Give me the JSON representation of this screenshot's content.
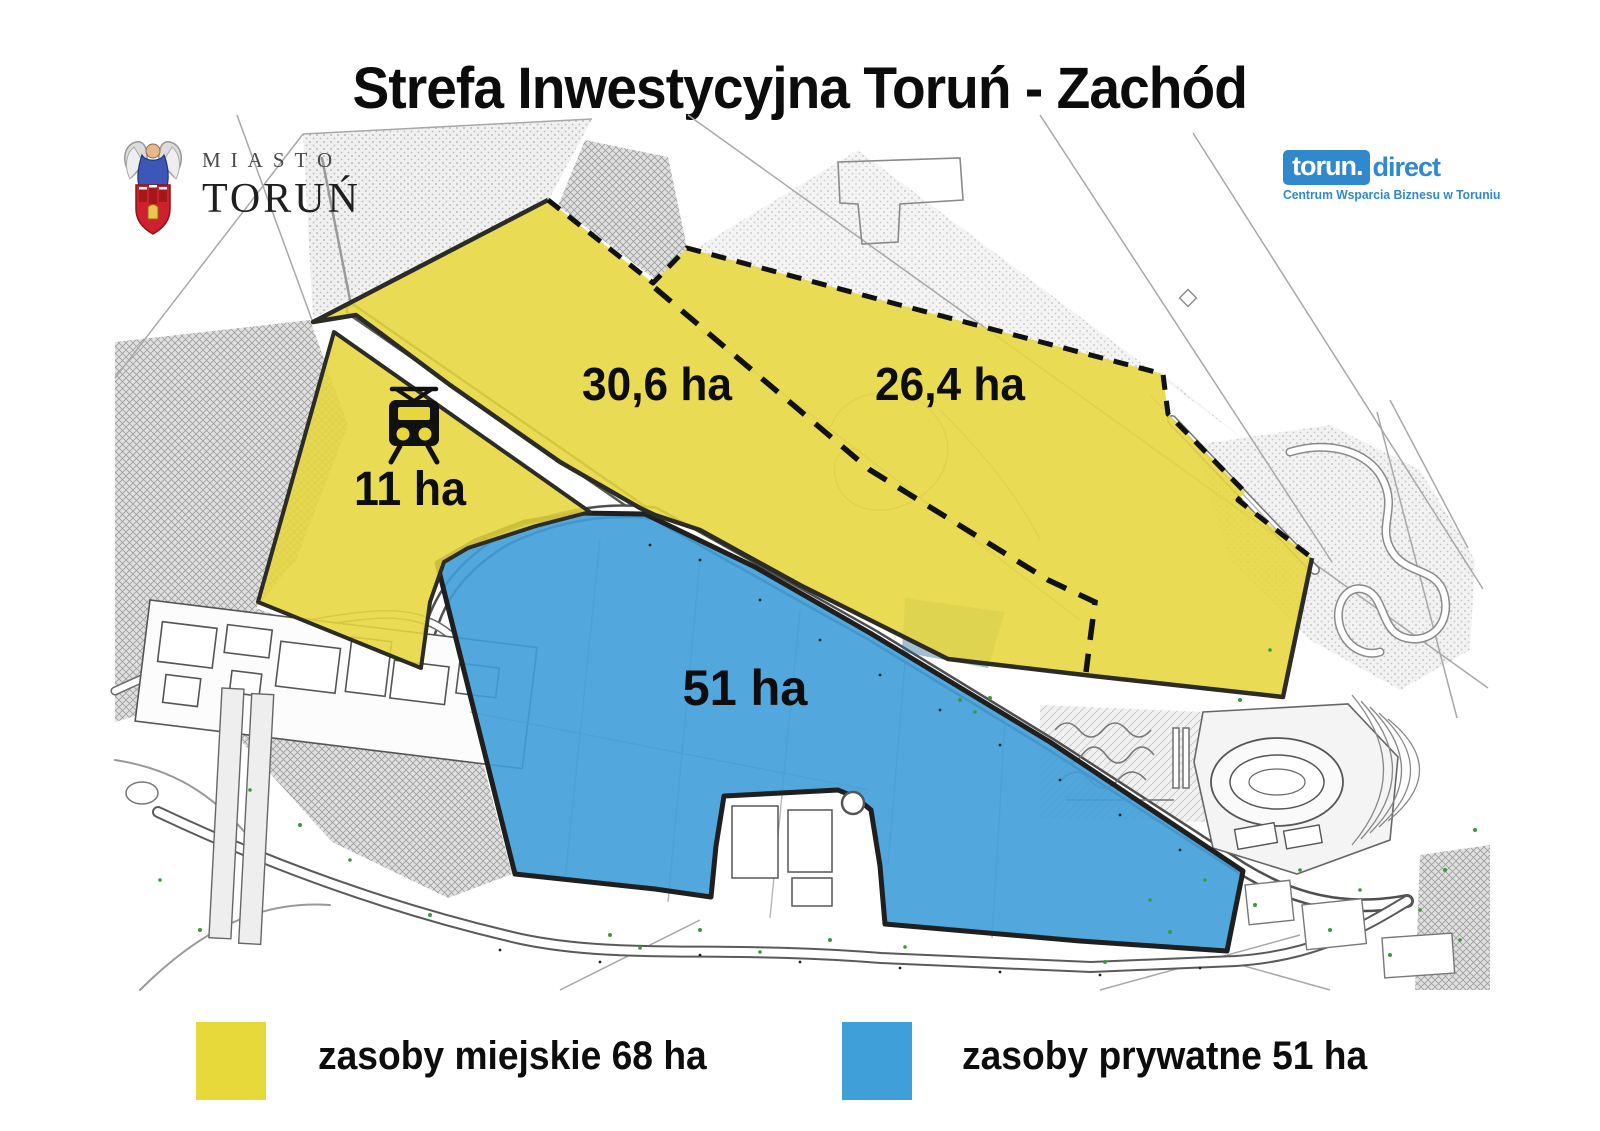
{
  "title": "Strefa Inwestycyjna Toruń - Zachód",
  "header": {
    "city_logo": {
      "line1": "MIASTO",
      "line2": "TORUŃ"
    },
    "partner_logo": {
      "brand_box": "torun.",
      "brand_rest": "direct",
      "tagline": "Centrum Wsparcia Biznesu w Toruniu"
    }
  },
  "map": {
    "areas": [
      {
        "id": "city-north-west",
        "label": "30,6 ha",
        "ownership": "miejskie"
      },
      {
        "id": "city-north-east",
        "label": "26,4 ha",
        "ownership": "miejskie"
      },
      {
        "id": "city-tram",
        "label": "11 ha",
        "ownership": "miejskie"
      },
      {
        "id": "private-south",
        "label": "51 ha",
        "ownership": "prywatne"
      }
    ],
    "icons": [
      {
        "name": "tram-icon"
      }
    ]
  },
  "legend": {
    "items": [
      {
        "label": "zasoby miejskie 68 ha",
        "color": "#e8d93b"
      },
      {
        "label": "zasoby prywatne 51 ha",
        "color": "#3f9fd8"
      }
    ]
  },
  "colors": {
    "city_area": "#e6d73c",
    "private_area": "#3f9fd8",
    "boundary": "#222222",
    "partner_blue": "#2f89cc"
  }
}
